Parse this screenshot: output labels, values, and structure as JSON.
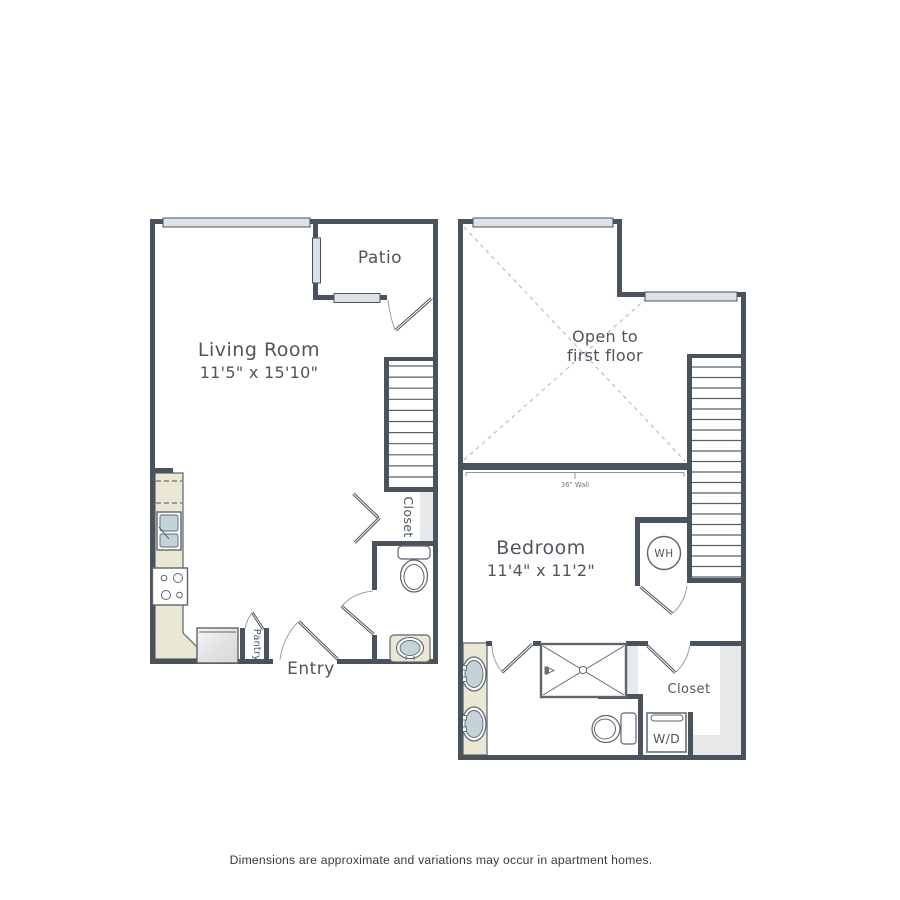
{
  "floor1": {
    "living_room_label": "Living Room",
    "living_room_dims": "11'5\" x 15'10\"",
    "patio_label": "Patio",
    "entry_label": "Entry",
    "pantry_label": "Pantry",
    "closet_label": "Closet"
  },
  "floor2": {
    "bedroom_label": "Bedroom",
    "bedroom_dims": "11'4\" x 11'2\"",
    "open_line1": "Open to",
    "open_line2": "first floor",
    "wall_note": "36\" Wall",
    "water_heater_label": "WH",
    "washer_dryer_label": "W/D",
    "closet_label": "Closet"
  },
  "footer": {
    "disclaimer": "Dimensions are approximate and variations may occur in apartment homes."
  },
  "colors": {
    "wall": "#4a525b",
    "window_fill": "#dde2e6",
    "counter": "#ebe7d5",
    "basin": "#c4d2da",
    "shelf": "#e8e9ea",
    "text": "#4d555e"
  }
}
